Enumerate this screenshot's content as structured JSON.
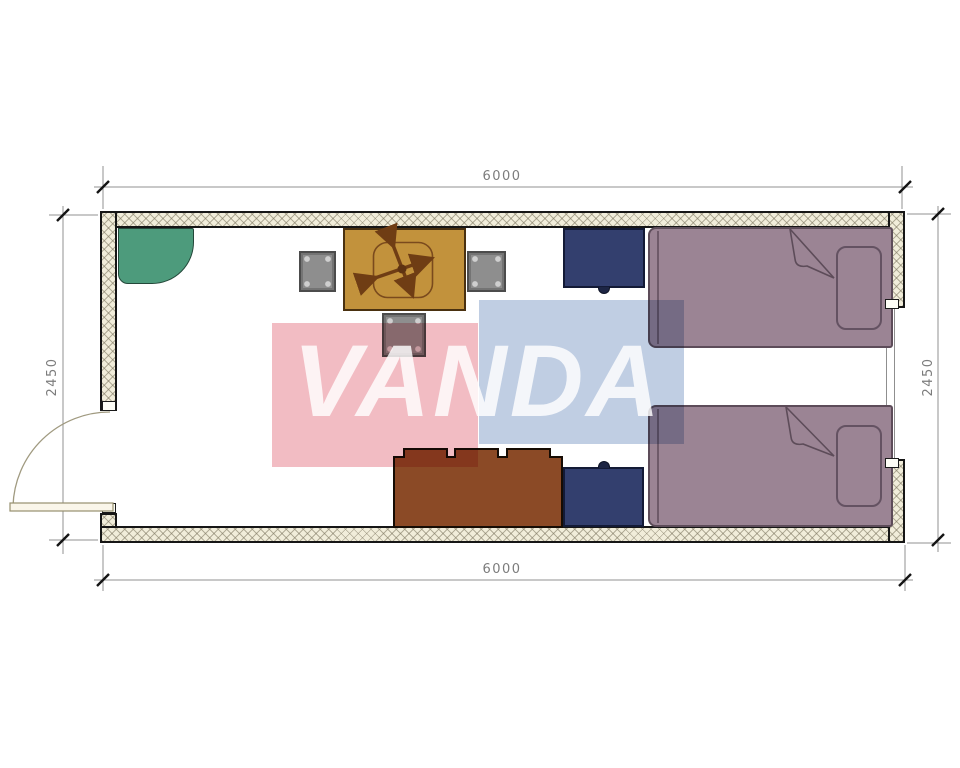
{
  "drawing": {
    "type": "floor-plan",
    "watermark_text": "VANDA",
    "dimensions": {
      "top": "6000",
      "bottom": "6000",
      "left": "2450",
      "right": "2450"
    },
    "colors": {
      "wall_fill": "#f1edda",
      "wall_outline": "#161616",
      "corner_cabinet": "#4d9b7c",
      "table": "#c2923c",
      "stool": "#8e8e8e",
      "nightstand": "#333f6e",
      "sofa": "#8b4a26",
      "bed": "#9b8494",
      "watermark_pink": "#f2bcc3",
      "watermark_blue": "#c0cee3"
    },
    "furniture": [
      "corner-cabinet",
      "table-with-cross-base",
      "stool-left",
      "stool-right",
      "stool-bottom",
      "nightstand-top",
      "nightstand-bottom",
      "sofa-sideboard",
      "bed-top",
      "bed-bottom"
    ],
    "openings": [
      "door-left-swing-out",
      "window-right"
    ]
  }
}
